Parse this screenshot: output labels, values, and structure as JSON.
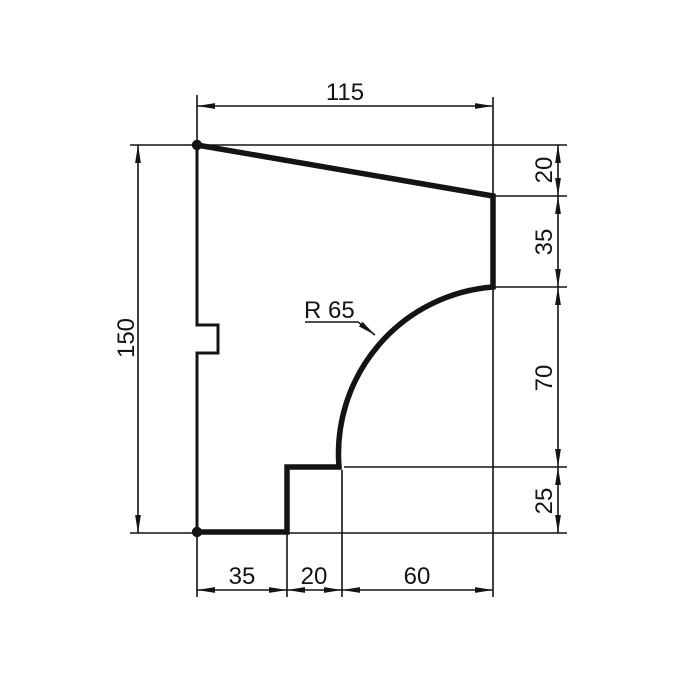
{
  "drawing": {
    "type": "technical-profile-drawing",
    "colors": {
      "line": "#141414",
      "background": "#ffffff"
    },
    "dimensions": {
      "top_width": "115",
      "total_height": "150",
      "right_top": "20",
      "right_upper": "35",
      "right_middle": "70",
      "right_bottom": "25",
      "bottom_left": "35",
      "bottom_middle": "20",
      "bottom_right": "60"
    },
    "radius_label": "R 65"
  }
}
